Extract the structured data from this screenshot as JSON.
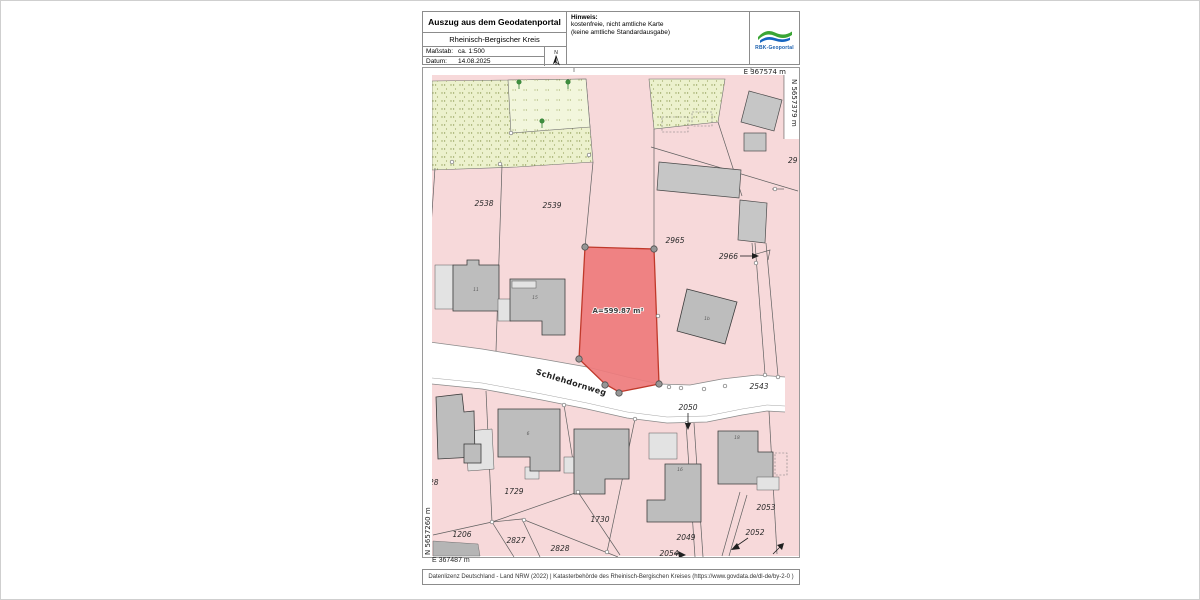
{
  "header": {
    "title": "Auszug aus dem Geodatenportal",
    "subtitle": "Rheinisch-Bergischer Kreis",
    "scale_label": "Maßstab:",
    "scale_value": "ca. 1:500",
    "date_label": "Datum:",
    "date_value": "14.08.2025",
    "north_label": "N",
    "hinweis_title": "Hinweis:",
    "hinweis_line1": "kostenfreie, nicht amtliche Karte",
    "hinweis_line2": "(keine amtliche Standardausgabe)",
    "logo_text": "RBK-Geoportal"
  },
  "map": {
    "coords": {
      "top_right": "E 367574 m",
      "right_top": "N 5657379 m",
      "left_bottom": "N 5657260 m",
      "bottom_left": "E 367487 m"
    },
    "street_name": "Schlehdornweg",
    "highlight": {
      "area_label": "A=599.87 m²"
    },
    "parcel_labels": {
      "p2538": "2538",
      "p2539": "2539",
      "p2965": "2965",
      "p2966": "2966",
      "p29": "29",
      "p2543": "2543",
      "p2050": "2050",
      "p1729": "1729",
      "p1730": "1730",
      "p1206": "1206",
      "p2827": "2827",
      "p2828": "2828",
      "p2049": "2049",
      "p2053": "2053",
      "p2052": "2052",
      "p2054": "2054",
      "p28": "28"
    },
    "house_numbers": {
      "h2538": "11",
      "h2539": "15",
      "h2965": "1b",
      "h1729": "6",
      "h2049": "16",
      "h2053": "18"
    }
  },
  "footer": {
    "license": "Datenlizenz Deutschland - Land NRW (2022) | Katasterbehörde des Rheinisch-Bergischen Kreises (https://www.govdata.de/dl-de/by-2-0 )"
  },
  "colors": {
    "parcel_pink": "#f7d9da",
    "highlight_red": "#ee7b7c",
    "highlight_border": "#c0392b",
    "vegetation_green": "#ecf1cd",
    "building_gray": "#bdbdbd",
    "logo_green": "#3aa535",
    "logo_blue": "#1565c0"
  }
}
